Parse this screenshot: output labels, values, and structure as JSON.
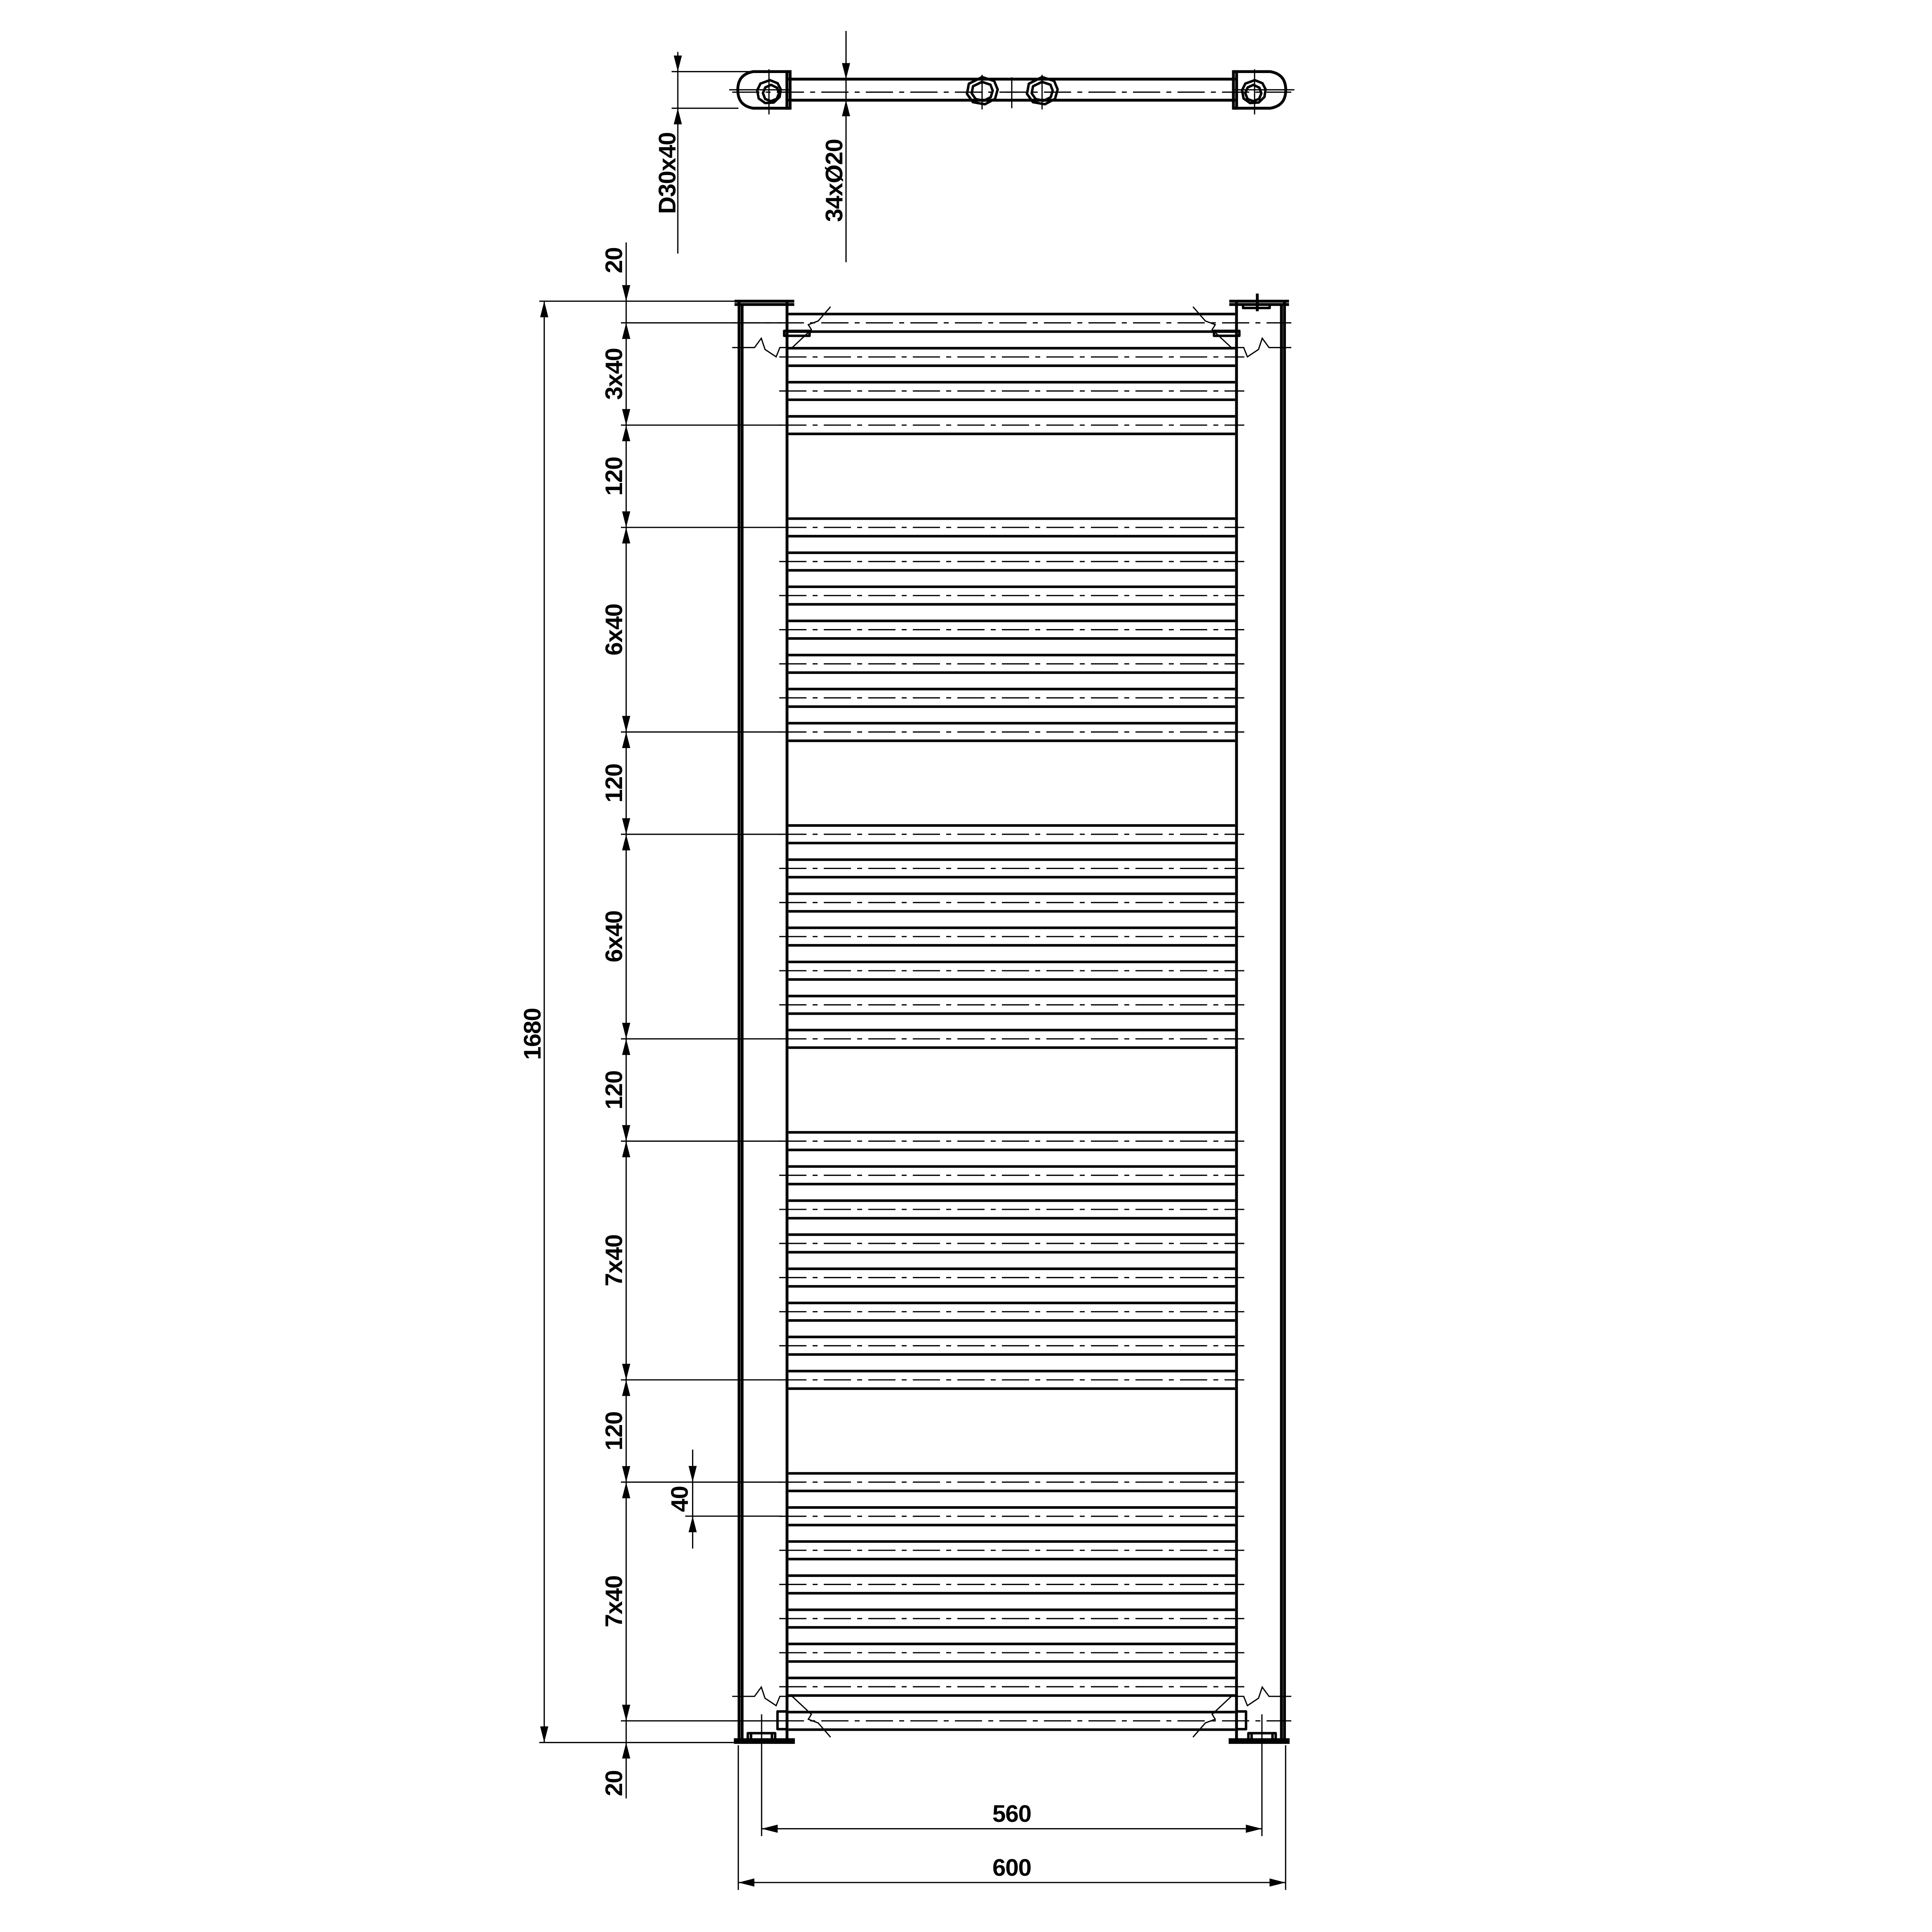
{
  "colors": {
    "ink": "#000000",
    "paper": "#ffffff"
  },
  "top_view": {
    "profile_dim_label": "D30x40",
    "rung_dim_label": "34xØ20"
  },
  "front_view": {
    "overall_height_label": "1680",
    "overall_height_mm": 1680,
    "chain": [
      {
        "label": "20",
        "from_mm": 0,
        "to_mm": 20,
        "arrows": "outside"
      },
      {
        "label": "3x40",
        "from_mm": 20,
        "to_mm": 140,
        "arrows": "inside"
      },
      {
        "label": "120",
        "from_mm": 140,
        "to_mm": 260,
        "arrows": "inside"
      },
      {
        "label": "6x40",
        "from_mm": 260,
        "to_mm": 500,
        "arrows": "inside"
      },
      {
        "label": "120",
        "from_mm": 500,
        "to_mm": 620,
        "arrows": "inside"
      },
      {
        "label": "6x40",
        "from_mm": 620,
        "to_mm": 860,
        "arrows": "inside"
      },
      {
        "label": "120",
        "from_mm": 860,
        "to_mm": 980,
        "arrows": "inside"
      },
      {
        "label": "7x40",
        "from_mm": 980,
        "to_mm": 1260,
        "arrows": "inside"
      },
      {
        "label": "120",
        "from_mm": 1260,
        "to_mm": 1380,
        "arrows": "inside"
      },
      {
        "label": "7x40",
        "from_mm": 1380,
        "to_mm": 1660,
        "arrows": "inside"
      },
      {
        "label": "20",
        "from_mm": 1660,
        "to_mm": 1680,
        "arrows": "outside"
      }
    ],
    "aux_dim": {
      "label": "40",
      "from_mm": 1380,
      "to_mm": 1420
    },
    "bottom_dims": {
      "inner_label": "560",
      "outer_label": "600"
    },
    "rung_count": 34,
    "rung_centerlines_mm": [
      20,
      60,
      100,
      140,
      260,
      300,
      340,
      380,
      420,
      460,
      500,
      620,
      660,
      700,
      740,
      780,
      820,
      860,
      980,
      1020,
      1060,
      1100,
      1140,
      1180,
      1220,
      1260,
      1380,
      1420,
      1460,
      1500,
      1540,
      1580,
      1620,
      1660
    ]
  }
}
